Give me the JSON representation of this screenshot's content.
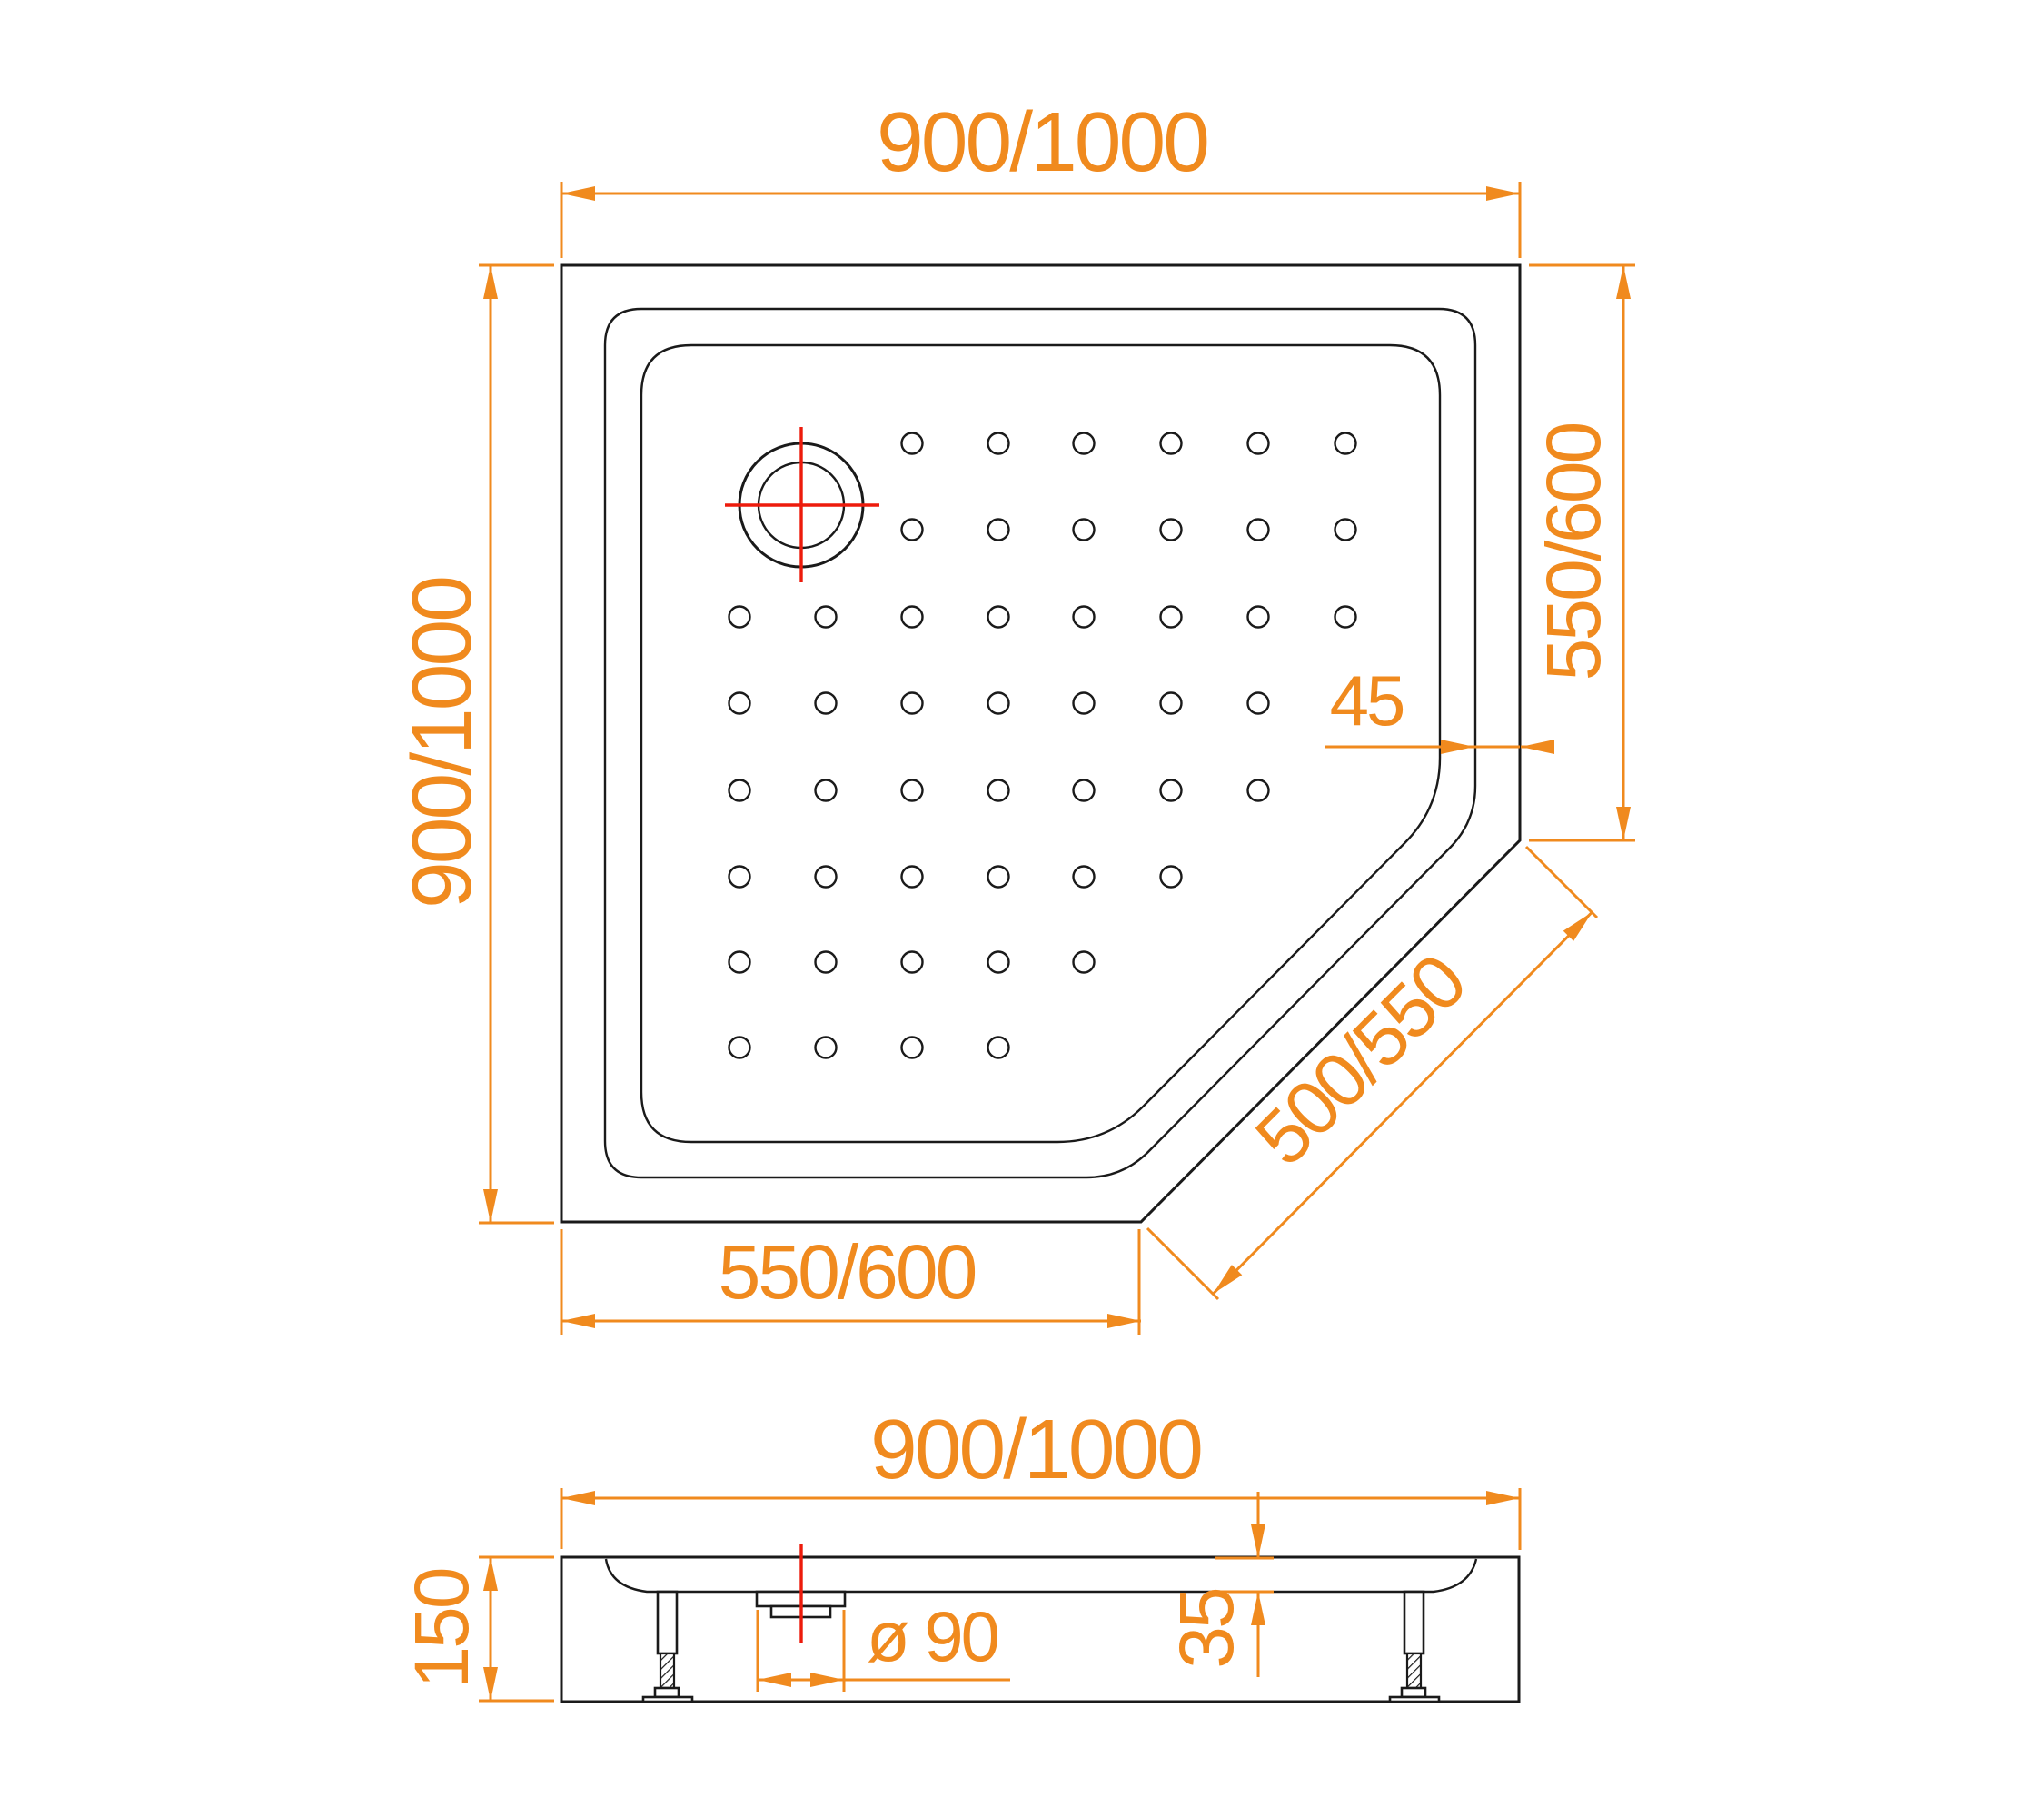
{
  "drawing": {
    "type": "technical-drawing",
    "subject": "pentagonal shower tray with anti-slip dots, plan view and side section view"
  },
  "colors": {
    "dimension_orange": "#F08A1E",
    "centerline_red": "#ED1B0C",
    "drawing_black": "#1A1A1A",
    "background": "#FFFFFF"
  },
  "plan_view": {
    "dim_top_width": "900/1000",
    "dim_left_height": "900/1000",
    "dim_right_edge": "550/600",
    "dim_bottom_edge": "550/600",
    "dim_diagonal_edge": "500/550",
    "dim_corner_offset": "45",
    "dot_grid": {
      "rows_y": [
        488,
        583,
        679,
        774,
        870,
        965,
        1059,
        1153
      ],
      "cols_x": [
        814,
        909,
        1004,
        1099,
        1193,
        1289,
        1385,
        1481
      ],
      "row_col_ranges": [
        [
          3,
          8
        ],
        [
          3,
          8
        ],
        [
          1,
          8
        ],
        [
          1,
          7
        ],
        [
          1,
          7
        ],
        [
          1,
          6
        ],
        [
          1,
          5
        ],
        [
          1,
          4
        ]
      ],
      "dot_radius": 11.5
    }
  },
  "section_view": {
    "dim_width": "900/1000",
    "dim_height": "150",
    "dim_drain_diameter": "ø 90",
    "dim_rim_depth": "35"
  }
}
